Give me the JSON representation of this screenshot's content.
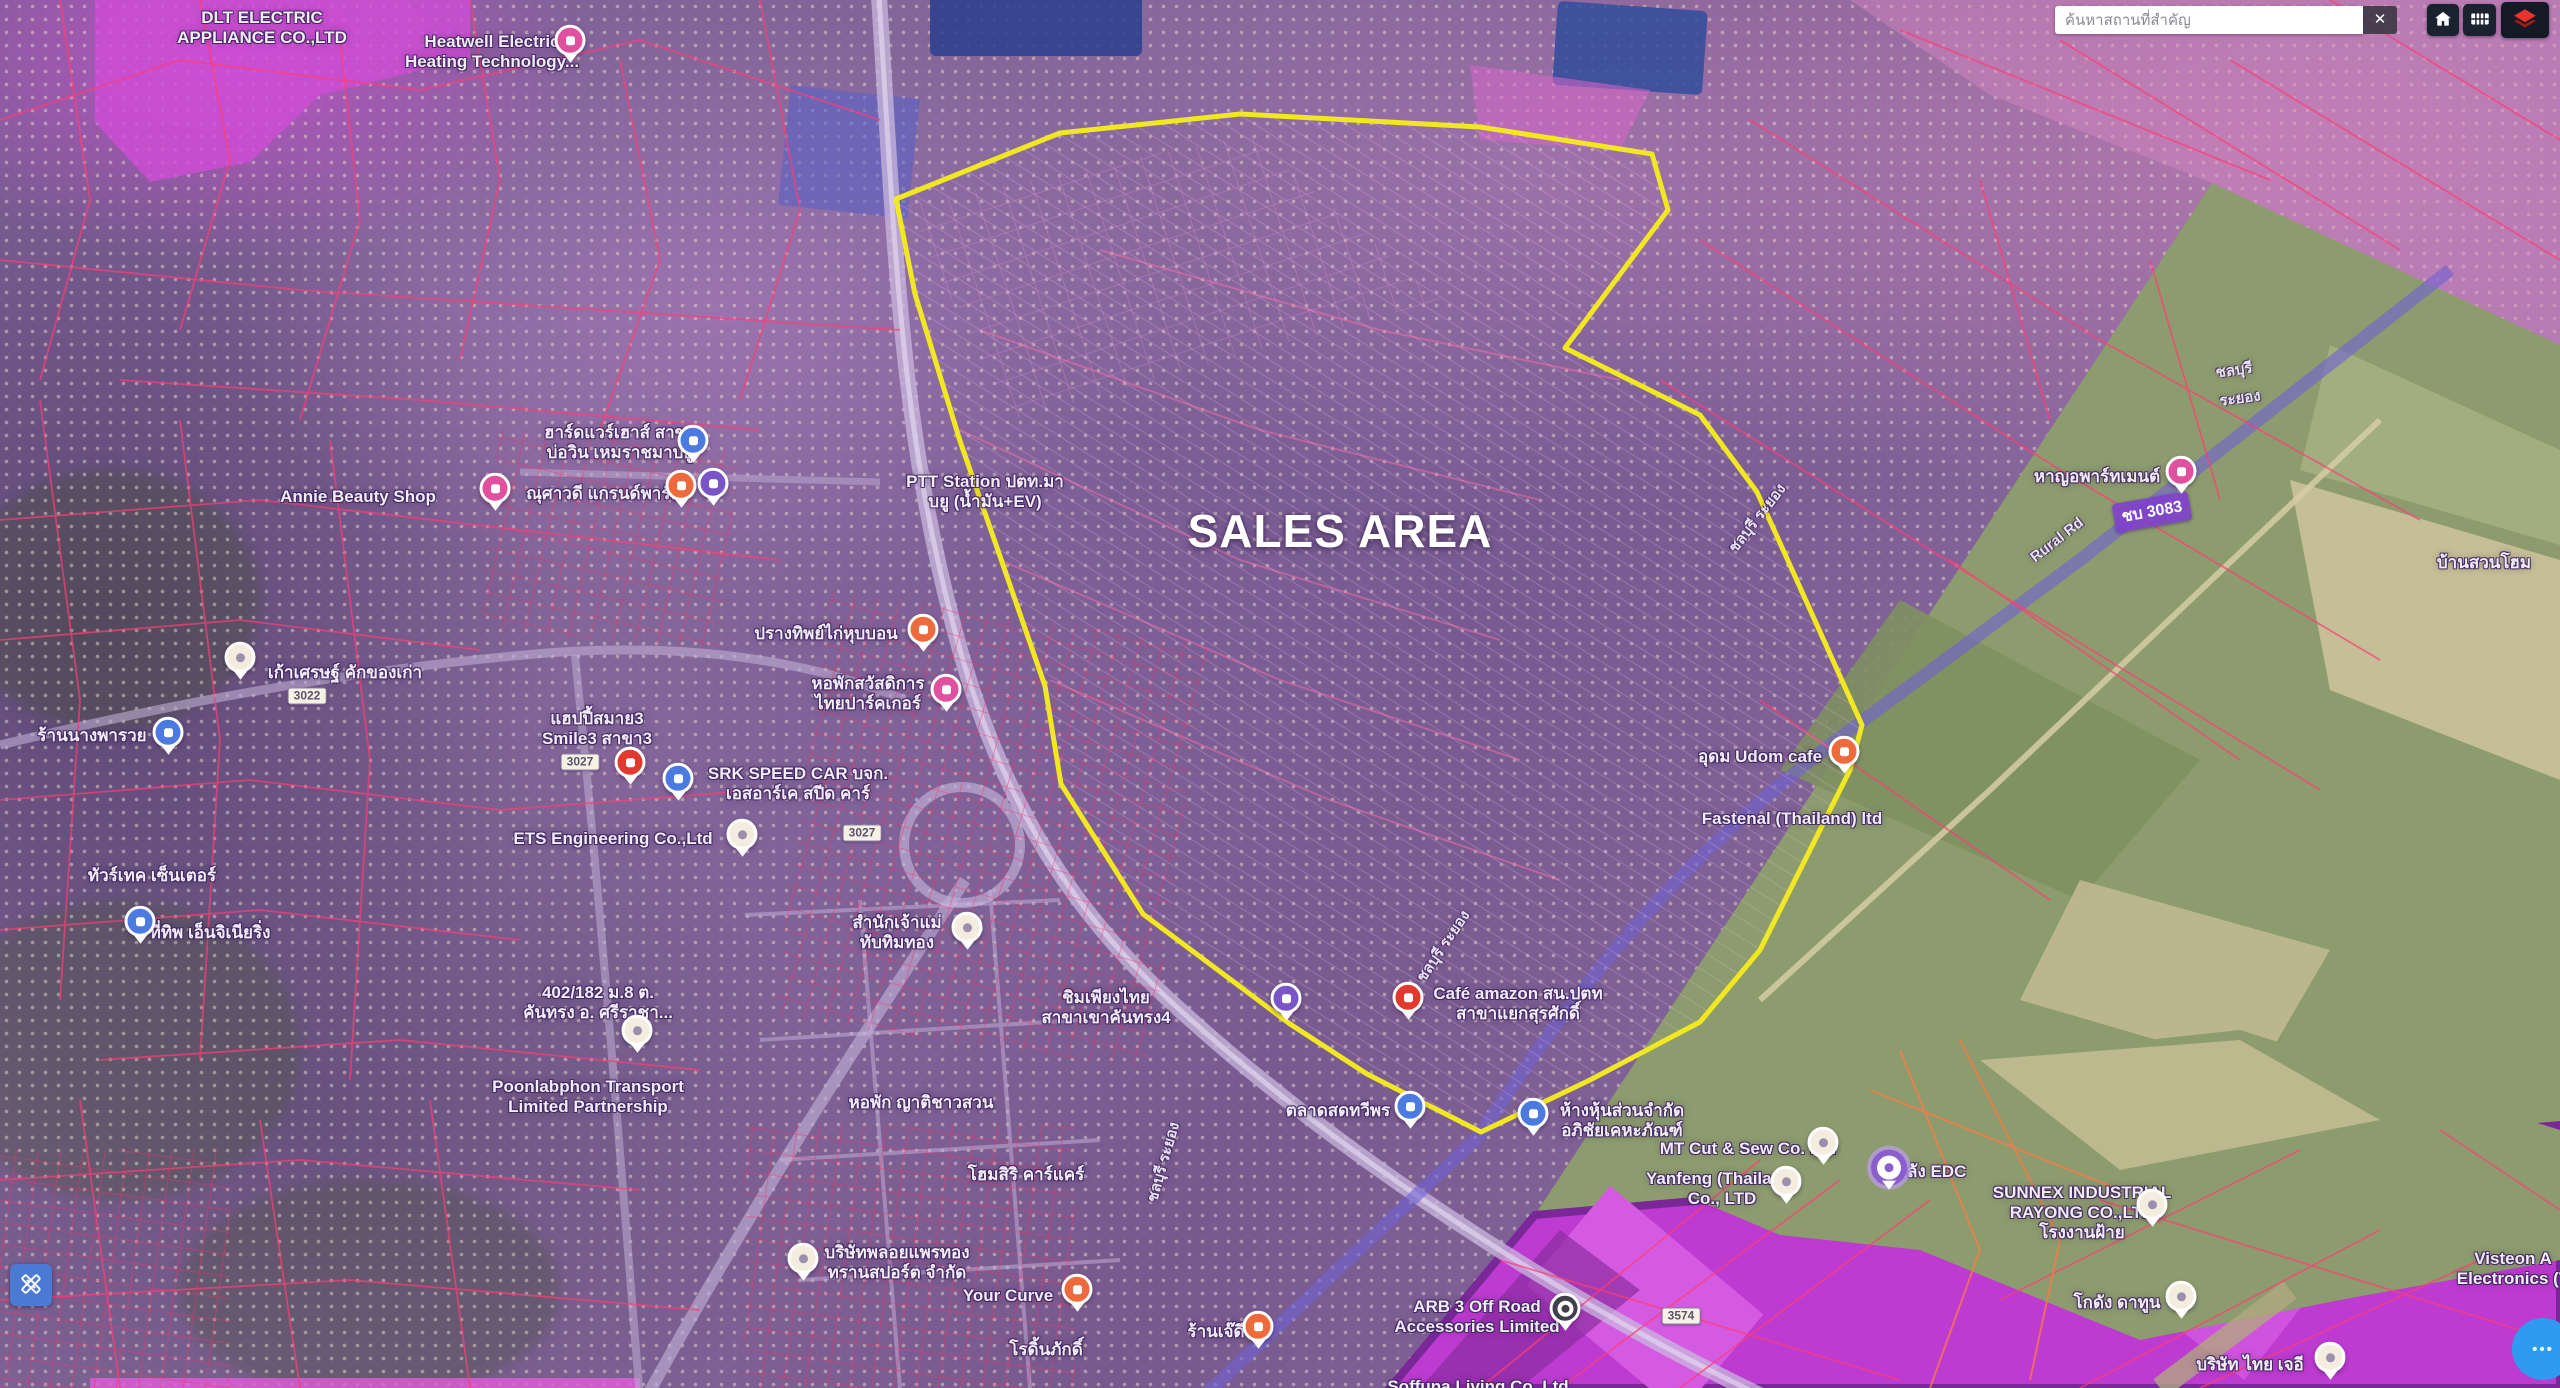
{
  "search": {
    "placeholder": "ค้นหาสถานที่สำคัญ",
    "clear_label": "✕"
  },
  "icons": {
    "clear": "clear-x",
    "home": "home-icon",
    "grid": "grid-table-icon",
    "layers": "layers-icon",
    "draw": "pencil-ruler-icon",
    "more_dots": "•••"
  },
  "colors": {
    "sales_outline": "#f2e822",
    "zone_magenta": "#c73fd4",
    "zone_green": "#8d9c6e",
    "cadastral_red": "#ff3d75",
    "accent_blue": "#2e9bf0"
  },
  "map": {
    "sales_area_label": "SALES AREA",
    "labels": [
      {
        "lines": [
          "DLT ELECTRIC",
          "APPLIANCE CO.,LTD"
        ],
        "x": 262,
        "y": 28
      },
      {
        "lines": [
          "Heatwell Electric",
          "Heating Technology..."
        ],
        "x": 492,
        "y": 52
      },
      {
        "lines": [
          "Annie Beauty Shop"
        ],
        "x": 358,
        "y": 497
      },
      {
        "lines": [
          "ฮาร์ดแวร์เฮาส์ สาขา",
          "บ่อวิน เหมราชมาบยู"
        ],
        "x": 620,
        "y": 443
      },
      {
        "lines": [
          "ณุศาวดี แกรนด์พาร์ค"
        ],
        "x": 604,
        "y": 494
      },
      {
        "lines": [
          "PTT Station ปตท.มา",
          "บยู (น้ำมัน+EV)"
        ],
        "x": 985,
        "y": 492
      },
      {
        "lines": [
          "เก้าเศรษฐ์ คักของเก่า"
        ],
        "x": 345,
        "y": 673
      },
      {
        "lines": [
          "ร้านนางพารวย"
        ],
        "x": 92,
        "y": 736
      },
      {
        "lines": [
          "ปรางทิพย์ไก่หุบบอน"
        ],
        "x": 826,
        "y": 634
      },
      {
        "lines": [
          "หอพักสวัสดิการ",
          "ไทยปาร์คเกอร์"
        ],
        "x": 868,
        "y": 694
      },
      {
        "lines": [
          "แฮปปี้สมาย3",
          "Smile3 สาขา3"
        ],
        "x": 597,
        "y": 729
      },
      {
        "lines": [
          "SRK SPEED CAR บจก.",
          "เอสอาร์เค สปีด คาร์"
        ],
        "x": 798,
        "y": 784
      },
      {
        "lines": [
          "ETS Engineering Co.,Ltd"
        ],
        "x": 613,
        "y": 839
      },
      {
        "lines": [
          "ทัวร์เทค เซ็นเตอร์"
        ],
        "x": 152,
        "y": 876
      },
      {
        "lines": [
          "ที่ทิพ เอ็นจิเนียริ่ง"
        ],
        "x": 210,
        "y": 933
      },
      {
        "lines": [
          "สำนักเจ้าแม่",
          "ทับทิมทอง"
        ],
        "x": 897,
        "y": 933
      },
      {
        "lines": [
          "402/182 ม.8 ต.",
          "คันทรง อ. ศรีราชา..."
        ],
        "x": 598,
        "y": 1003
      },
      {
        "lines": [
          "Poonlabphon Transport",
          "Limited Partnership"
        ],
        "x": 588,
        "y": 1097
      },
      {
        "lines": [
          "หอพัก ญาติชาวสวน"
        ],
        "x": 921,
        "y": 1103
      },
      {
        "lines": [
          "ชิมเพียงไทย",
          "สาขาเขาคันทรง4"
        ],
        "x": 1106,
        "y": 1008
      },
      {
        "lines": [
          "Café amazon สน.ปตท",
          "สาขาแยกสุรศักดิ์"
        ],
        "x": 1518,
        "y": 1004
      },
      {
        "lines": [
          "ตลาดสดทวีพร"
        ],
        "x": 1338,
        "y": 1111
      },
      {
        "lines": [
          "ห้างหุ้นส่วนจำกัด",
          "อภิชัยเคหะภัณฑ์"
        ],
        "x": 1622,
        "y": 1121
      },
      {
        "lines": [
          "โฮมสิริ คาร์แคร์"
        ],
        "x": 1026,
        "y": 1175
      },
      {
        "lines": [
          "บริษัทพลอยแพรทอง",
          "ทรานสปอร์ต จำกัด"
        ],
        "x": 897,
        "y": 1263
      },
      {
        "lines": [
          "Your Curve"
        ],
        "x": 1008,
        "y": 1296
      },
      {
        "lines": [
          "โรดิ้นภักดิ์"
        ],
        "x": 1046,
        "y": 1350
      },
      {
        "lines": [
          "ร้านเจ๊ดี"
        ],
        "x": 1216,
        "y": 1332
      },
      {
        "lines": [
          "ARB 3 Off Road",
          "Accessories Limited"
        ],
        "x": 1477,
        "y": 1317
      },
      {
        "lines": [
          "Soffuna Living Co. Ltd"
        ],
        "x": 1478,
        "y": 1387
      },
      {
        "lines": [
          "MT Cut & Sew Co. Ltd"
        ],
        "x": 1748,
        "y": 1149
      },
      {
        "lines": [
          "Yanfeng (Thailand)",
          "Co., LTD"
        ],
        "x": 1722,
        "y": 1189
      },
      {
        "lines": [
          "คลัง EDC"
        ],
        "x": 1931,
        "y": 1172
      },
      {
        "lines": [
          "SUNNEX INDUSTRIAL",
          "RAYONG CO.,LTD",
          "โรงงานฝ้าย"
        ],
        "x": 2082,
        "y": 1213
      },
      {
        "lines": [
          "โกดัง ดาทูน"
        ],
        "x": 2117,
        "y": 1303
      },
      {
        "lines": [
          "บริษัท ไทย เจอี"
        ],
        "x": 2250,
        "y": 1365
      },
      {
        "lines": [
          "Visteon A",
          "Electronics (T"
        ],
        "x": 2513,
        "y": 1269
      },
      {
        "lines": [
          "อุดม Udom cafe"
        ],
        "x": 1760,
        "y": 757
      },
      {
        "lines": [
          "Fastenal (Thailand) ltd"
        ],
        "x": 1792,
        "y": 819
      },
      {
        "lines": [
          "หาญอพาร์ทเมนต์"
        ],
        "x": 2097,
        "y": 477
      },
      {
        "lines": [
          "บ้านสวนโฮม"
        ],
        "x": 2484,
        "y": 563
      }
    ],
    "road_labels": [
      {
        "text": "ชลบุรี",
        "x": 2234,
        "y": 370,
        "rot": -8
      },
      {
        "text": "ระยอง",
        "x": 2240,
        "y": 398,
        "rot": -8
      },
      {
        "text": "Rural Rd",
        "x": 2057,
        "y": 540,
        "rot": -38
      },
      {
        "text": "ชบ 3083",
        "x": 2152,
        "y": 512,
        "rot": -10,
        "hl": true
      },
      {
        "text": "ชลบุรี ระยอง",
        "x": 1757,
        "y": 518,
        "rot": -52
      },
      {
        "text": "ชลบุรี ระยอง",
        "x": 1443,
        "y": 946,
        "rot": -56
      },
      {
        "text": "ชลบุรี ระยอง",
        "x": 1163,
        "y": 1162,
        "rot": -74
      }
    ],
    "shields": [
      {
        "text": "3022",
        "x": 307,
        "y": 696
      },
      {
        "text": "3027",
        "x": 580,
        "y": 762
      },
      {
        "text": "3027",
        "x": 862,
        "y": 833
      },
      {
        "text": "3574",
        "x": 1681,
        "y": 1316
      }
    ],
    "pins": [
      {
        "x": 570,
        "y": 44,
        "t": "pink"
      },
      {
        "x": 693,
        "y": 444,
        "t": "blue"
      },
      {
        "x": 495,
        "y": 492,
        "t": "pink"
      },
      {
        "x": 681,
        "y": 489,
        "t": "orange"
      },
      {
        "x": 713,
        "y": 487,
        "t": "purple"
      },
      {
        "x": 240,
        "y": 661,
        "t": "white"
      },
      {
        "x": 168,
        "y": 736,
        "t": "blue"
      },
      {
        "x": 140,
        "y": 925,
        "t": "blue"
      },
      {
        "x": 923,
        "y": 633,
        "t": "orange"
      },
      {
        "x": 946,
        "y": 693,
        "t": "pink"
      },
      {
        "x": 630,
        "y": 766,
        "t": "red"
      },
      {
        "x": 678,
        "y": 782,
        "t": "blue"
      },
      {
        "x": 742,
        "y": 838,
        "t": "white"
      },
      {
        "x": 967,
        "y": 931,
        "t": "white"
      },
      {
        "x": 637,
        "y": 1034,
        "t": "white"
      },
      {
        "x": 1286,
        "y": 1002,
        "t": "purple"
      },
      {
        "x": 1408,
        "y": 1001,
        "t": "red"
      },
      {
        "x": 1410,
        "y": 1110,
        "t": "blue"
      },
      {
        "x": 1533,
        "y": 1117,
        "t": "blue"
      },
      {
        "x": 803,
        "y": 1262,
        "t": "white"
      },
      {
        "x": 1077,
        "y": 1293,
        "t": "orange"
      },
      {
        "x": 1258,
        "y": 1330,
        "t": "orange"
      },
      {
        "x": 1565,
        "y": 1312,
        "t": "dark"
      },
      {
        "x": 1823,
        "y": 1146,
        "t": "white"
      },
      {
        "x": 1786,
        "y": 1185,
        "t": "white"
      },
      {
        "x": 1889,
        "y": 1172,
        "t": "ring"
      },
      {
        "x": 2152,
        "y": 1208,
        "t": "white"
      },
      {
        "x": 2181,
        "y": 1300,
        "t": "white"
      },
      {
        "x": 2330,
        "y": 1361,
        "t": "white"
      },
      {
        "x": 1844,
        "y": 755,
        "t": "orange"
      },
      {
        "x": 2181,
        "y": 475,
        "t": "pink"
      }
    ]
  }
}
